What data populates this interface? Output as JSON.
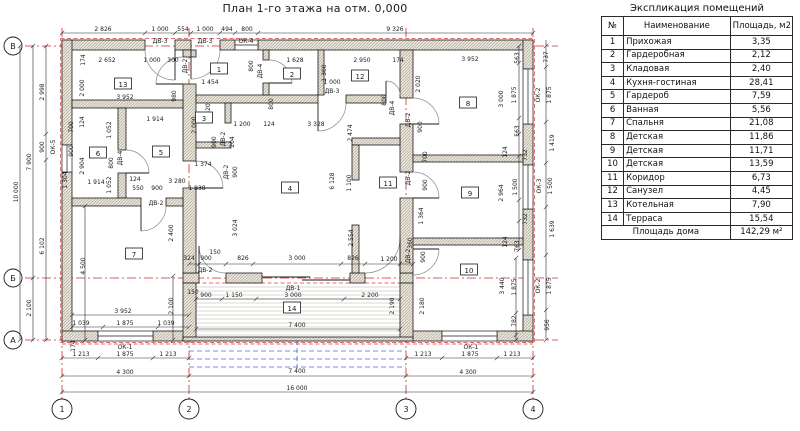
{
  "title": "План 1-го этажа на отм. 0,000",
  "table": {
    "title": "Экспликация помещений",
    "headers": [
      "№",
      "Наименование",
      "Площадь, м2"
    ],
    "rows": [
      [
        "1",
        "Прихожая",
        "3,35"
      ],
      [
        "2",
        "Гардеробная",
        "2,12"
      ],
      [
        "3",
        "Кладовая",
        "2,40"
      ],
      [
        "4",
        "Кухня-гостиная",
        "28,41"
      ],
      [
        "5",
        "Гардероб",
        "7,59"
      ],
      [
        "6",
        "Ванная",
        "5,56"
      ],
      [
        "7",
        "Спальня",
        "21,08"
      ],
      [
        "8",
        "Детская",
        "11,86"
      ],
      [
        "9",
        "Детская",
        "11,71"
      ],
      [
        "10",
        "Детская",
        "13,59"
      ],
      [
        "11",
        "Коридор",
        "6,73"
      ],
      [
        "12",
        "Санузел",
        "4,45"
      ],
      [
        "13",
        "Котельная",
        "7,90"
      ],
      [
        "14",
        "Терраса",
        "15,54"
      ]
    ],
    "footer": {
      "label": "Площадь дома",
      "value": "142,29 м²"
    }
  },
  "axes": {
    "row_bubbles": [
      {
        "t": "В",
        "x": 13,
        "y": 46
      },
      {
        "t": "Б",
        "x": 13,
        "y": 278
      },
      {
        "t": "А",
        "x": 13,
        "y": 340
      }
    ],
    "col_bubbles": [
      {
        "t": "1",
        "x": 62,
        "y": 409
      },
      {
        "t": "2",
        "x": 189,
        "y": 409
      },
      {
        "t": "3",
        "x": 406,
        "y": 409
      },
      {
        "t": "4",
        "x": 533,
        "y": 409
      }
    ]
  },
  "plan": {
    "rooms": [
      {
        "n": "1",
        "x": 219,
        "y": 69
      },
      {
        "n": "2",
        "x": 292,
        "y": 74
      },
      {
        "n": "3",
        "x": 204,
        "y": 118
      },
      {
        "n": "4",
        "x": 290,
        "y": 188
      },
      {
        "n": "5",
        "x": 161,
        "y": 152
      },
      {
        "n": "6",
        "x": 98,
        "y": 153
      },
      {
        "n": "7",
        "x": 134,
        "y": 254
      },
      {
        "n": "8",
        "x": 468,
        "y": 103
      },
      {
        "n": "9",
        "x": 470,
        "y": 193
      },
      {
        "n": "10",
        "x": 469,
        "y": 270
      },
      {
        "n": "11",
        "x": 388,
        "y": 183
      },
      {
        "n": "12",
        "x": 360,
        "y": 76
      },
      {
        "n": "13",
        "x": 123,
        "y": 84
      },
      {
        "n": "14",
        "x": 292,
        "y": 308
      }
    ],
    "labels": [
      {
        "t": "2 826",
        "x": 103,
        "y": 31
      },
      {
        "t": "1 000",
        "x": 160,
        "y": 31
      },
      {
        "t": "554",
        "x": 183,
        "y": 31
      },
      {
        "t": "1 000",
        "x": 205,
        "y": 31
      },
      {
        "t": "494",
        "x": 227,
        "y": 31
      },
      {
        "t": "800",
        "x": 247,
        "y": 31
      },
      {
        "t": "9 326",
        "x": 395,
        "y": 31
      },
      {
        "t": "ДВ-3",
        "x": 160,
        "y": 43
      },
      {
        "t": "ДВ-3",
        "x": 205,
        "y": 43
      },
      {
        "t": "ОК-4",
        "x": 246,
        "y": 43
      },
      {
        "t": "174",
        "x": 85,
        "y": 60,
        "r": 1
      },
      {
        "t": "2 652",
        "x": 107,
        "y": 62
      },
      {
        "t": "1 000",
        "x": 152,
        "y": 62
      },
      {
        "t": "300",
        "x": 173,
        "y": 62
      },
      {
        "t": "1 628",
        "x": 295,
        "y": 62
      },
      {
        "t": "2 950",
        "x": 362,
        "y": 62
      },
      {
        "t": "174",
        "x": 398,
        "y": 62
      },
      {
        "t": "3 952",
        "x": 470,
        "y": 61
      },
      {
        "t": "563",
        "x": 519,
        "y": 58,
        "r": 1
      },
      {
        "t": "737",
        "x": 548,
        "y": 57,
        "r": 1
      },
      {
        "t": "ДВ-2",
        "x": 187,
        "y": 66,
        "r": 1
      },
      {
        "t": "800",
        "x": 253,
        "y": 66,
        "r": 1
      },
      {
        "t": "ДВ-4",
        "x": 262,
        "y": 71,
        "r": 1
      },
      {
        "t": "1 300",
        "x": 326,
        "y": 73,
        "r": 1
      },
      {
        "t": "800",
        "x": 386,
        "y": 100,
        "r": 1
      },
      {
        "t": "ДВ-4",
        "x": 394,
        "y": 108,
        "r": 1
      },
      {
        "t": "2 020",
        "x": 420,
        "y": 84,
        "r": 1
      },
      {
        "t": "3 000",
        "x": 503,
        "y": 99,
        "r": 1
      },
      {
        "t": "1 875",
        "x": 516,
        "y": 95,
        "r": 1
      },
      {
        "t": "ОК-2",
        "x": 540,
        "y": 95,
        "r": 1
      },
      {
        "t": "1 875",
        "x": 551,
        "y": 95,
        "r": 1
      },
      {
        "t": "2 000",
        "x": 84,
        "y": 88,
        "r": 1
      },
      {
        "t": "980",
        "x": 176,
        "y": 96,
        "r": 1
      },
      {
        "t": "1 454",
        "x": 210,
        "y": 84
      },
      {
        "t": "1 000",
        "x": 332,
        "y": 84
      },
      {
        "t": "ДВ-3",
        "x": 332,
        "y": 93
      },
      {
        "t": "620",
        "x": 210,
        "y": 109,
        "r": 1
      },
      {
        "t": "3 952",
        "x": 125,
        "y": 99
      },
      {
        "t": "1 200",
        "x": 242,
        "y": 126
      },
      {
        "t": "124",
        "x": 269,
        "y": 126
      },
      {
        "t": "3 328",
        "x": 316,
        "y": 126
      },
      {
        "t": "800",
        "x": 273,
        "y": 104,
        "r": 1
      },
      {
        "t": "2 474",
        "x": 352,
        "y": 133,
        "r": 1
      },
      {
        "t": "2 000",
        "x": 196,
        "y": 125,
        "r": 1
      },
      {
        "t": "900",
        "x": 216,
        "y": 142,
        "r": 1
      },
      {
        "t": "ДВ-2",
        "x": 225,
        "y": 139,
        "r": 1
      },
      {
        "t": "204",
        "x": 234,
        "y": 142,
        "r": 1
      },
      {
        "t": "700",
        "x": 73,
        "y": 127,
        "r": 1
      },
      {
        "t": "124",
        "x": 84,
        "y": 122,
        "r": 1
      },
      {
        "t": "1 052",
        "x": 111,
        "y": 130,
        "r": 1
      },
      {
        "t": "1 914",
        "x": 155,
        "y": 121
      },
      {
        "t": "900",
        "x": 73,
        "y": 151,
        "r": 1
      },
      {
        "t": "2 904",
        "x": 84,
        "y": 166,
        "r": 1
      },
      {
        "t": "800",
        "x": 113,
        "y": 163,
        "r": 1
      },
      {
        "t": "ДВ-4",
        "x": 122,
        "y": 158,
        "r": 1
      },
      {
        "t": "1 304",
        "x": 67,
        "y": 180,
        "r": 1
      },
      {
        "t": "1 052",
        "x": 111,
        "y": 185,
        "r": 1
      },
      {
        "t": "1 914",
        "x": 96,
        "y": 184
      },
      {
        "t": "124",
        "x": 135,
        "y": 181
      },
      {
        "t": "550",
        "x": 138,
        "y": 190
      },
      {
        "t": "900",
        "x": 157,
        "y": 190
      },
      {
        "t": "3 280",
        "x": 177,
        "y": 183
      },
      {
        "t": "1 374",
        "x": 203,
        "y": 166
      },
      {
        "t": "ДВ-2",
        "x": 228,
        "y": 172,
        "r": 1
      },
      {
        "t": "900",
        "x": 237,
        "y": 172,
        "r": 1
      },
      {
        "t": "1 838",
        "x": 197,
        "y": 190
      },
      {
        "t": "ДВ-2",
        "x": 156,
        "y": 205
      },
      {
        "t": "2 400",
        "x": 173,
        "y": 233,
        "r": 1
      },
      {
        "t": "3 024",
        "x": 237,
        "y": 228,
        "r": 1
      },
      {
        "t": "6 128",
        "x": 334,
        "y": 181,
        "r": 1
      },
      {
        "t": "1 100",
        "x": 351,
        "y": 183,
        "r": 1
      },
      {
        "t": "2 554",
        "x": 353,
        "y": 238,
        "r": 1
      },
      {
        "t": "563",
        "x": 519,
        "y": 131,
        "r": 1
      },
      {
        "t": "732",
        "x": 527,
        "y": 155,
        "r": 1
      },
      {
        "t": "1 500",
        "x": 517,
        "y": 187,
        "r": 1
      },
      {
        "t": "732",
        "x": 527,
        "y": 219,
        "r": 1
      },
      {
        "t": "124",
        "x": 507,
        "y": 152,
        "r": 1
      },
      {
        "t": "124",
        "x": 507,
        "y": 242,
        "r": 1
      },
      {
        "t": "763",
        "x": 519,
        "y": 246,
        "r": 1
      },
      {
        "t": "2 964",
        "x": 503,
        "y": 193,
        "r": 1
      },
      {
        "t": "900",
        "x": 422,
        "y": 127,
        "r": 1
      },
      {
        "t": "ДВ-2",
        "x": 410,
        "y": 120,
        "r": 1
      },
      {
        "t": "700",
        "x": 427,
        "y": 157,
        "r": 1
      },
      {
        "t": "ДВ-2",
        "x": 410,
        "y": 178,
        "r": 1
      },
      {
        "t": "900",
        "x": 427,
        "y": 185,
        "r": 1
      },
      {
        "t": "1 364",
        "x": 423,
        "y": 216,
        "r": 1
      },
      {
        "t": "360",
        "x": 412,
        "y": 243,
        "r": 1
      },
      {
        "t": "ДВ-2",
        "x": 410,
        "y": 256,
        "r": 1
      },
      {
        "t": "900",
        "x": 425,
        "y": 257,
        "r": 1
      },
      {
        "t": "1 419",
        "x": 554,
        "y": 143,
        "r": 1
      },
      {
        "t": "ОК-3",
        "x": 541,
        "y": 186,
        "r": 1
      },
      {
        "t": "1 500",
        "x": 552,
        "y": 186,
        "r": 1
      },
      {
        "t": "1 639",
        "x": 554,
        "y": 229,
        "r": 1
      },
      {
        "t": "3 440",
        "x": 504,
        "y": 286,
        "r": 1
      },
      {
        "t": "1 875",
        "x": 516,
        "y": 287,
        "r": 1
      },
      {
        "t": "782",
        "x": 516,
        "y": 321,
        "r": 1
      },
      {
        "t": "ОК-2",
        "x": 540,
        "y": 286,
        "r": 1
      },
      {
        "t": "1 875",
        "x": 551,
        "y": 286,
        "r": 1
      },
      {
        "t": "956",
        "x": 549,
        "y": 325,
        "r": 1
      },
      {
        "t": "2 180",
        "x": 424,
        "y": 306,
        "r": 1
      },
      {
        "t": "2 190",
        "x": 394,
        "y": 306,
        "r": 1
      },
      {
        "t": "10 000",
        "x": 18,
        "y": 192,
        "r": 1
      },
      {
        "t": "7 900",
        "x": 31,
        "y": 162,
        "r": 1
      },
      {
        "t": "2 100",
        "x": 31,
        "y": 308,
        "r": 1
      },
      {
        "t": "2 998",
        "x": 44,
        "y": 92,
        "r": 1
      },
      {
        "t": "900",
        "x": 44,
        "y": 147,
        "r": 1
      },
      {
        "t": "ОК-5",
        "x": 55,
        "y": 147,
        "r": 1
      },
      {
        "t": "6 102",
        "x": 44,
        "y": 246,
        "r": 1
      },
      {
        "t": "4 500",
        "x": 85,
        "y": 266,
        "r": 1
      },
      {
        "t": "2 100",
        "x": 173,
        "y": 306,
        "r": 1
      },
      {
        "t": "174",
        "x": 75,
        "y": 346,
        "r": 1
      },
      {
        "t": "324",
        "x": 189,
        "y": 260
      },
      {
        "t": "900",
        "x": 206,
        "y": 260
      },
      {
        "t": "150",
        "x": 215,
        "y": 254
      },
      {
        "t": "826",
        "x": 243,
        "y": 260
      },
      {
        "t": "3 000",
        "x": 297,
        "y": 260
      },
      {
        "t": "826",
        "x": 353,
        "y": 260
      },
      {
        "t": "1 200",
        "x": 389,
        "y": 261
      },
      {
        "t": "ДВ-2",
        "x": 205,
        "y": 272
      },
      {
        "t": "ДВ-1",
        "x": 293,
        "y": 290
      },
      {
        "t": "150",
        "x": 193,
        "y": 294
      },
      {
        "t": "900",
        "x": 206,
        "y": 297
      },
      {
        "t": "1 150",
        "x": 234,
        "y": 297
      },
      {
        "t": "3 000",
        "x": 293,
        "y": 297
      },
      {
        "t": "2 200",
        "x": 370,
        "y": 297
      },
      {
        "t": "7 400",
        "x": 297,
        "y": 327
      },
      {
        "t": "3 952",
        "x": 123,
        "y": 313
      },
      {
        "t": "1 039",
        "x": 81,
        "y": 325
      },
      {
        "t": "1 875",
        "x": 125,
        "y": 325
      },
      {
        "t": "1 039",
        "x": 166,
        "y": 325
      },
      {
        "t": "ОК-1",
        "x": 125,
        "y": 349
      },
      {
        "t": "1 213",
        "x": 81,
        "y": 356
      },
      {
        "t": "1 875",
        "x": 125,
        "y": 356
      },
      {
        "t": "1 213",
        "x": 168,
        "y": 356
      },
      {
        "t": "4 300",
        "x": 125,
        "y": 374
      },
      {
        "t": "ОК-1",
        "x": 471,
        "y": 349
      },
      {
        "t": "1 213",
        "x": 423,
        "y": 356
      },
      {
        "t": "1 875",
        "x": 470,
        "y": 356
      },
      {
        "t": "1 213",
        "x": 512,
        "y": 356
      },
      {
        "t": "4 300",
        "x": 468,
        "y": 374
      },
      {
        "t": "7 400",
        "x": 297,
        "y": 373
      },
      {
        "t": "16 000",
        "x": 297,
        "y": 390
      }
    ],
    "dimlines": [
      {
        "o": "h",
        "c": 33,
        "a": 62,
        "b": 533,
        "t": [
          62,
          145,
          175,
          191,
          220,
          235,
          258,
          533
        ]
      },
      {
        "o": "h",
        "c": 264,
        "a": 189,
        "b": 413,
        "t": [
          189,
          199,
          226,
          253,
          341,
          365,
          400,
          413
        ]
      },
      {
        "o": "h",
        "c": 299,
        "a": 196,
        "b": 400,
        "t": [
          196,
          222,
          256,
          344,
          400
        ]
      },
      {
        "o": "h",
        "c": 315,
        "a": 72,
        "b": 189,
        "t": [
          72,
          189
        ]
      },
      {
        "o": "h",
        "c": 327,
        "a": 72,
        "b": 189,
        "t": [
          72,
          103,
          158,
          189
        ]
      },
      {
        "o": "h",
        "c": 329,
        "a": 196,
        "b": 400,
        "t": [
          196,
          400
        ]
      },
      {
        "o": "h",
        "c": 358,
        "a": 62,
        "b": 189,
        "t": [
          62,
          98,
          153,
          189
        ]
      },
      {
        "o": "h",
        "c": 358,
        "a": 406,
        "b": 533,
        "t": [
          406,
          442,
          497,
          533
        ]
      },
      {
        "o": "h",
        "c": 376,
        "a": 62,
        "b": 533,
        "t": [
          62,
          189,
          406,
          533
        ]
      },
      {
        "o": "h",
        "c": 392,
        "a": 62,
        "b": 533,
        "t": [
          62,
          533
        ]
      },
      {
        "o": "v",
        "c": 20,
        "a": 46,
        "b": 340,
        "t": [
          46,
          340
        ]
      },
      {
        "o": "v",
        "c": 33,
        "a": 46,
        "b": 340,
        "t": [
          46,
          278,
          340
        ]
      },
      {
        "o": "v",
        "c": 46,
        "a": 46,
        "b": 340,
        "t": [
          46,
          134,
          160,
          340
        ]
      },
      {
        "o": "v",
        "c": 85,
        "a": 206,
        "b": 340,
        "t": [
          206,
          340
        ]
      },
      {
        "o": "v",
        "c": 173,
        "a": 276,
        "b": 340,
        "t": [
          276,
          340
        ]
      },
      {
        "o": "v",
        "c": 546,
        "a": 40,
        "b": 340,
        "t": [
          46,
          67,
          122,
          163,
          207,
          255,
          310,
          340
        ]
      },
      {
        "o": "v",
        "c": 519,
        "a": 46,
        "b": 250,
        "t": [
          46,
          63,
          118,
          134,
          156,
          200,
          221,
          250
        ]
      },
      {
        "o": "v",
        "c": 516,
        "a": 258,
        "b": 340,
        "t": [
          258,
          313,
          335,
          340
        ]
      }
    ]
  }
}
